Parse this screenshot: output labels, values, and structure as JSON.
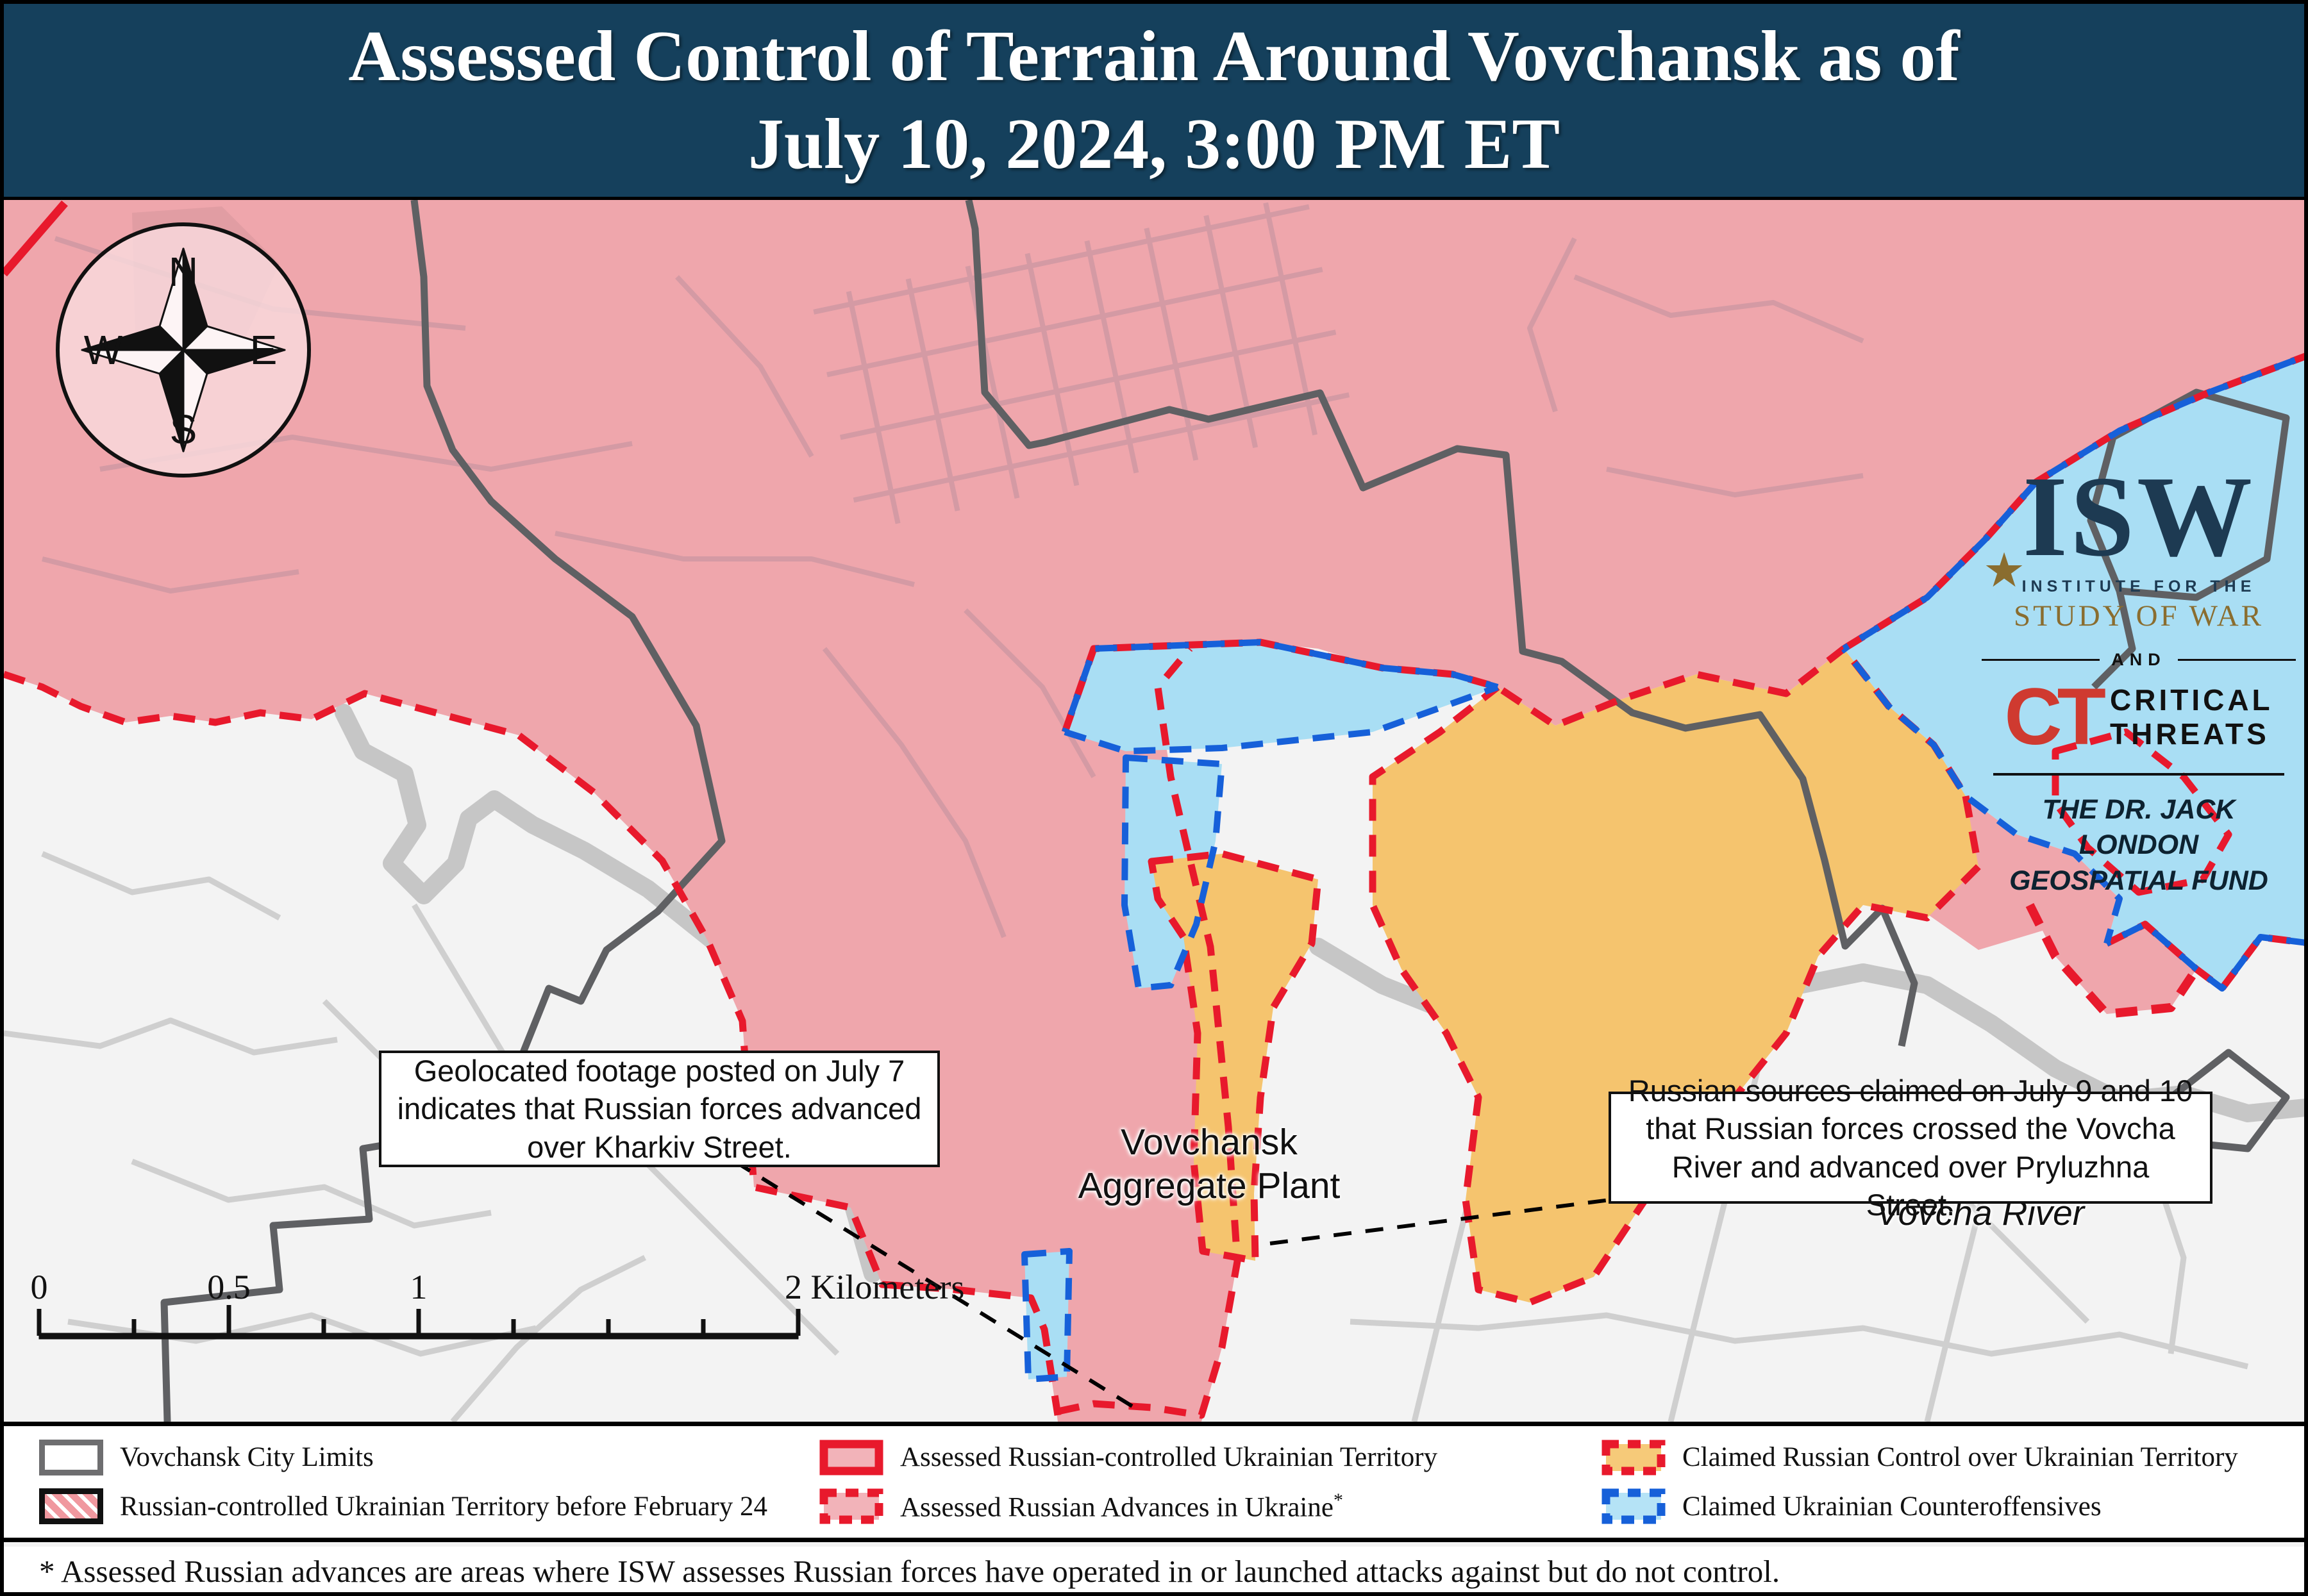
{
  "title": {
    "line1": "Assessed Control of Terrain Around Vovchansk as of",
    "line2": "July 10, 2024, 3:00 PM ET"
  },
  "logo": {
    "isw": "ISW",
    "star": "★",
    "institute": "INSTITUTE FOR THE",
    "study": "STUDY OF WAR",
    "and": "AND",
    "ct": "CT",
    "critical": "CRITICAL",
    "threats": "THREATS",
    "fund_line1": "THE DR. JACK LONDON",
    "fund_line2": "GEOSPATIAL FUND"
  },
  "compass": {
    "n": "N",
    "e": "E",
    "s": "S",
    "w": "W"
  },
  "callouts": [
    {
      "text": "Geolocated footage posted on July 7 indicates that Russian forces advanced over Kharkiv Street."
    },
    {
      "text": "Russian sources claimed on July 9 and 10 that Russian forces crossed the Vovcha River and advanced over Pryluzhna Street."
    }
  ],
  "map_labels": {
    "plant": "Vovchansk Aggregate Plant",
    "river": "Vovcha River"
  },
  "scale": {
    "t0": "0",
    "t05": "0.5",
    "t1": "1",
    "t2": "2 Kilometers"
  },
  "credits": {
    "line1": "Map by George Barros, Kateryna Stepanenko, Noel Mikkelsen, Daniel Mealie, Thomas Bergeron, Mitchell Belcher, Tom Thacker, Benjamin Cordola, and Harrison Hurwitz",
    "line2": "© 2024 Institute for the Study of War and AEI's Critical Threats Project"
  },
  "legend": {
    "items": [
      {
        "label": "Vovchansk City Limits",
        "fill": "#ffffff",
        "border": "#6e6e70",
        "style": "solid-gray"
      },
      {
        "label": "Russian-controlled Ukrainian Territory before February 24",
        "fill": "#f0989f",
        "border": "#111111",
        "style": "red-stripes"
      },
      {
        "label": "Assessed Russian-controlled Ukrainian Territory",
        "fill": "#f2b3b9",
        "border": "#e8192c",
        "style": "solid-red"
      },
      {
        "label": "Assessed Russian Advances in Ukraine",
        "label_suffix": "*",
        "fill": "#f2b3b9",
        "border": "#e8192c",
        "style": "dashed-red"
      },
      {
        "label": "Claimed Russian Control over Ukrainian Territory",
        "fill": "#f6ca79",
        "border": "#e8192c",
        "style": "dashed-red"
      },
      {
        "label": "Claimed Ukrainian Counteroffensives",
        "fill": "#b5e3f6",
        "border": "#1660d9",
        "style": "dashed-blue"
      }
    ]
  },
  "footnote": "* Assessed Russian advances are areas where ISW assesses Russian forces have operated in or launched attacks against but do not control.",
  "colors": {
    "title_bg": "#15405c",
    "russian_controlled": "#efa6ac",
    "claimed_russian": "#f5c46e",
    "claimed_ukrainian": "#a9def4",
    "advance_border": "#e8192c",
    "counteroffensive_border": "#1660d9",
    "city_limits_line": "#5f6063",
    "river": "#c6c6c6",
    "map_bg": "#f3f3f3"
  }
}
